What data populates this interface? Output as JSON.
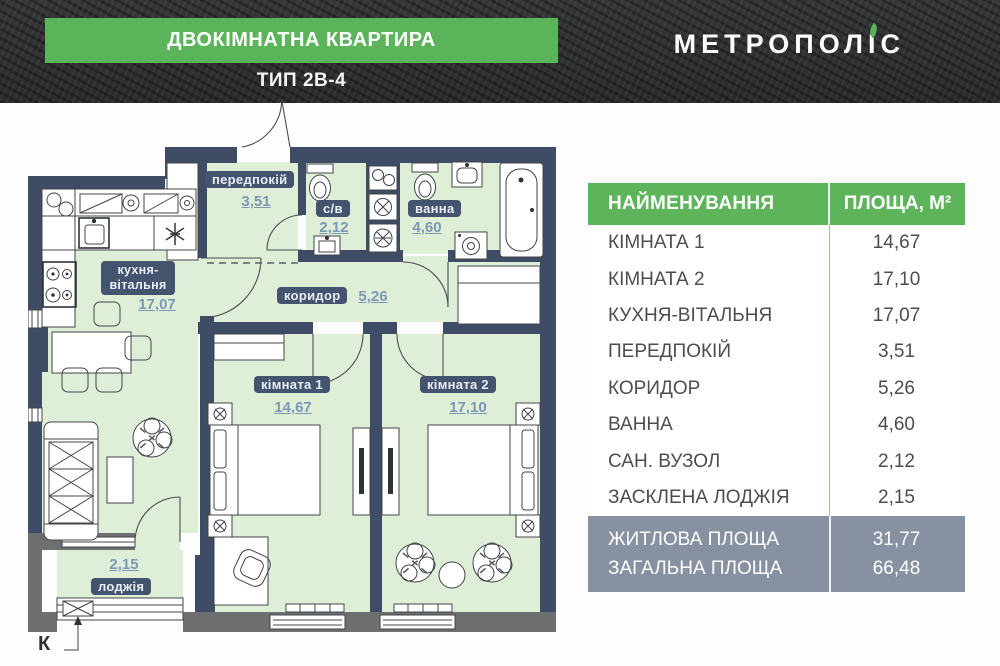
{
  "header": {
    "title": "ДВОКІМНАТНА КВАРТИРА",
    "subtitle": "ТИП 2В-4",
    "logo": {
      "part1": "МЕТРОПОЛ",
      "part2": "І",
      "part3": "С"
    }
  },
  "plan": {
    "rooms": {
      "hall": {
        "label": "передпокій",
        "area": "3,51"
      },
      "wc": {
        "label": "с/в",
        "area": "2,12"
      },
      "bath": {
        "label": "ванна",
        "area": "4,60"
      },
      "corridor": {
        "label": "коридор",
        "area": "5,26"
      },
      "kitchen": {
        "label_line1": "кухня-",
        "label_line2": "вітальня",
        "area": "17,07"
      },
      "room1": {
        "label": "кімната 1",
        "area": "14,67"
      },
      "room2": {
        "label": "кімната 2",
        "area": "17,10"
      },
      "loggia": {
        "label": "лоджія",
        "area": "2,15"
      }
    },
    "marker_k": "К"
  },
  "table": {
    "col_name": "НАЙМЕНУВАННЯ",
    "col_area": "ПЛОЩА, М²",
    "rows": [
      {
        "name": "КІМНАТА 1",
        "area": "14,67"
      },
      {
        "name": "КІМНАТА 2",
        "area": "17,10"
      },
      {
        "name": "КУХНЯ-ВІТАЛЬНЯ",
        "area": "17,07"
      },
      {
        "name": "ПЕРЕДПОКІЙ",
        "area": "3,51"
      },
      {
        "name": "КОРИДОР",
        "area": "5,26"
      },
      {
        "name": "ВАННА",
        "area": "4,60"
      },
      {
        "name": "САН. ВУЗОЛ",
        "area": "2,12"
      },
      {
        "name": "ЗАСКЛЕНА ЛОДЖІЯ",
        "area": "2,15"
      }
    ],
    "summary": [
      {
        "name": "ЖИТЛОВА ПЛОЩА",
        "area": "31,77"
      },
      {
        "name": "ЗАГАЛЬНА ПЛОЩА",
        "area": "66,48"
      }
    ]
  },
  "colors": {
    "accent_green": "#5cb45a",
    "wall_slate": "#3e4c66",
    "room_green": "#dfeed6",
    "summary_gray": "#8791a2"
  }
}
